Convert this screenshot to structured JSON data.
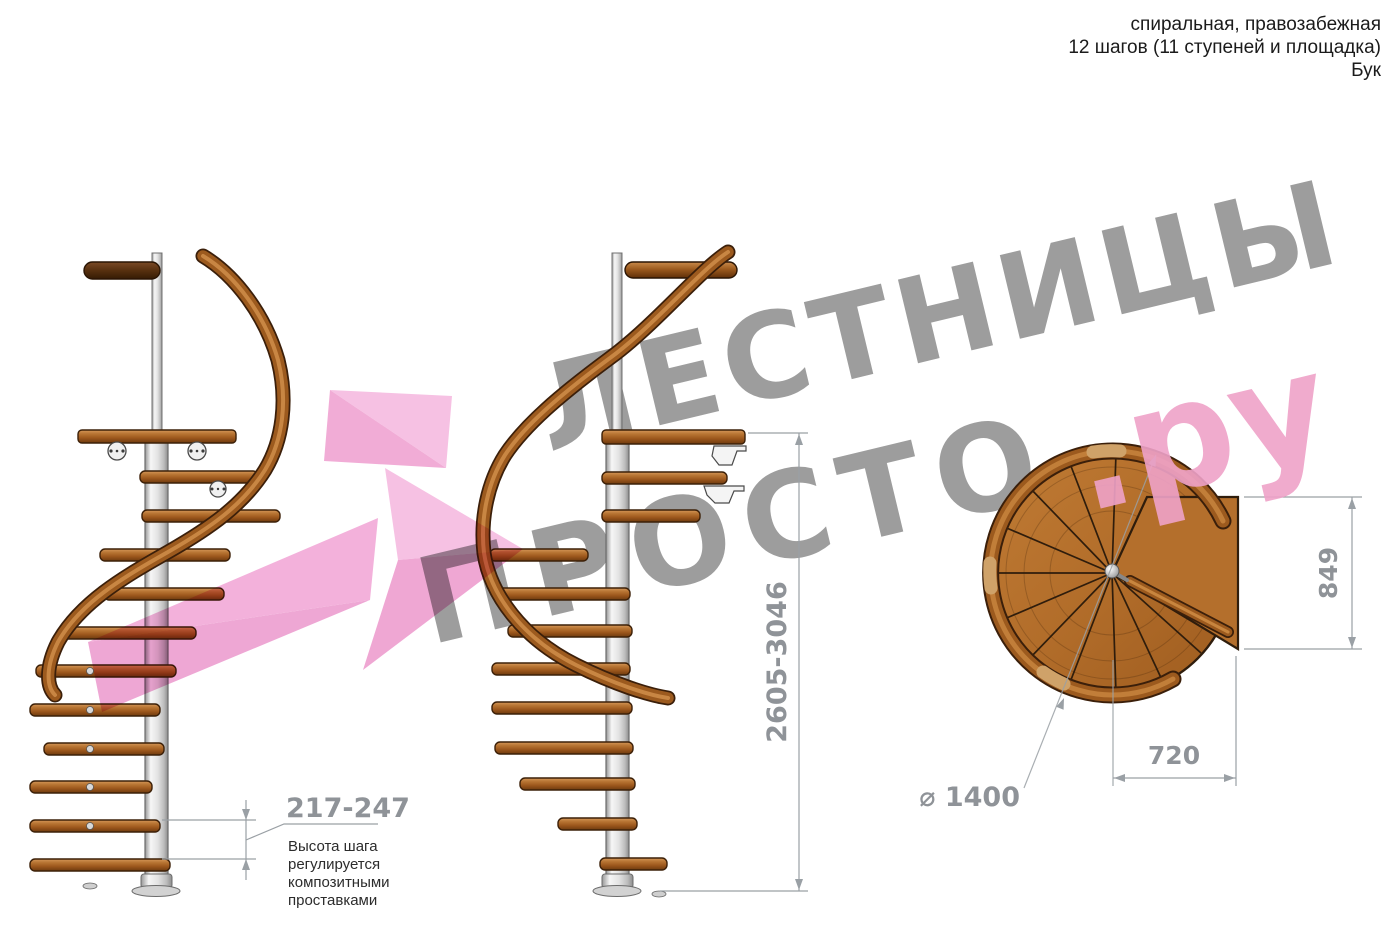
{
  "header": {
    "type_line": "спиральная, правозабежная",
    "steps_line": "12 шагов (11 ступеней и площадка)",
    "material_line": "Бук"
  },
  "watermark": {
    "word_top": "ЛЕСТНИЦЫ",
    "word_bottom": "ПРОСТО",
    "word_domain": ".ру",
    "gray_color": "#9d9d9d",
    "pink_color": "#efa2c8",
    "arrow_pink_color": "#f2abd8"
  },
  "elevation": {
    "total_height": "2605-3046",
    "step_height": "217-247",
    "step_note": [
      "Высота шага",
      "регулируется",
      "композитными",
      "проставками"
    ]
  },
  "plan_view": {
    "diameter_label": "⌀ 1400",
    "landing_depth": "849",
    "landing_width": "720"
  },
  "colors": {
    "wood": "#a5601f",
    "wood_light": "#d79a55",
    "wood_dark": "#5f2f08",
    "steel": "#e8e8e8",
    "dimension": "#9aa0a5",
    "dimension_text": "#8f9398",
    "note_text": "#2c2c2c"
  }
}
